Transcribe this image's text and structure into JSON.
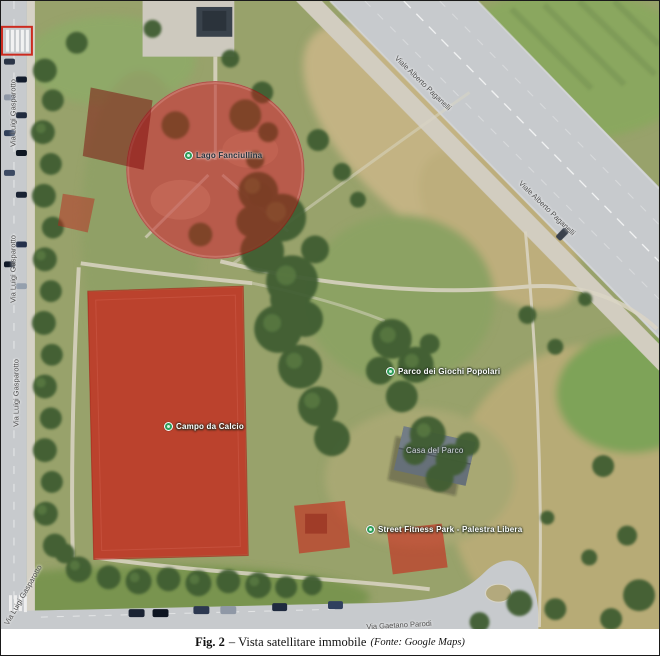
{
  "caption": {
    "prefix": "Fig. 2",
    "title": "– Vista satellitare immobile",
    "source": "(Fonte: Google Maps)"
  },
  "map": {
    "provider": "Google Maps",
    "highlight_color": "#c02318",
    "pois": [
      {
        "id": "lago",
        "label": "Lago Fanciullina"
      },
      {
        "id": "campo-calcio",
        "label": "Campo da Calcio"
      },
      {
        "id": "giochi",
        "label": "Parco dei Giochi Popolari"
      },
      {
        "id": "fitness",
        "label": "Street Fitness Park - Palestra Libera"
      },
      {
        "id": "casa-parco",
        "label": "Casa del Parco"
      }
    ],
    "roads": [
      {
        "id": "viale-top",
        "label": "Viale Alberto Paganelli"
      },
      {
        "id": "viale-mid",
        "label": "Viale Alberto Paganelli"
      },
      {
        "id": "via-left-1",
        "label": "Via Luigi Gasparotto"
      },
      {
        "id": "via-left-2",
        "label": "Via Luigi Gasparotto"
      },
      {
        "id": "via-left-3",
        "label": "Via Luigi Gasparotto"
      },
      {
        "id": "via-corner",
        "label": "Via Luigi Gasparotto"
      },
      {
        "id": "via-bottom",
        "label": "Via Gaetano Parodi"
      }
    ]
  }
}
